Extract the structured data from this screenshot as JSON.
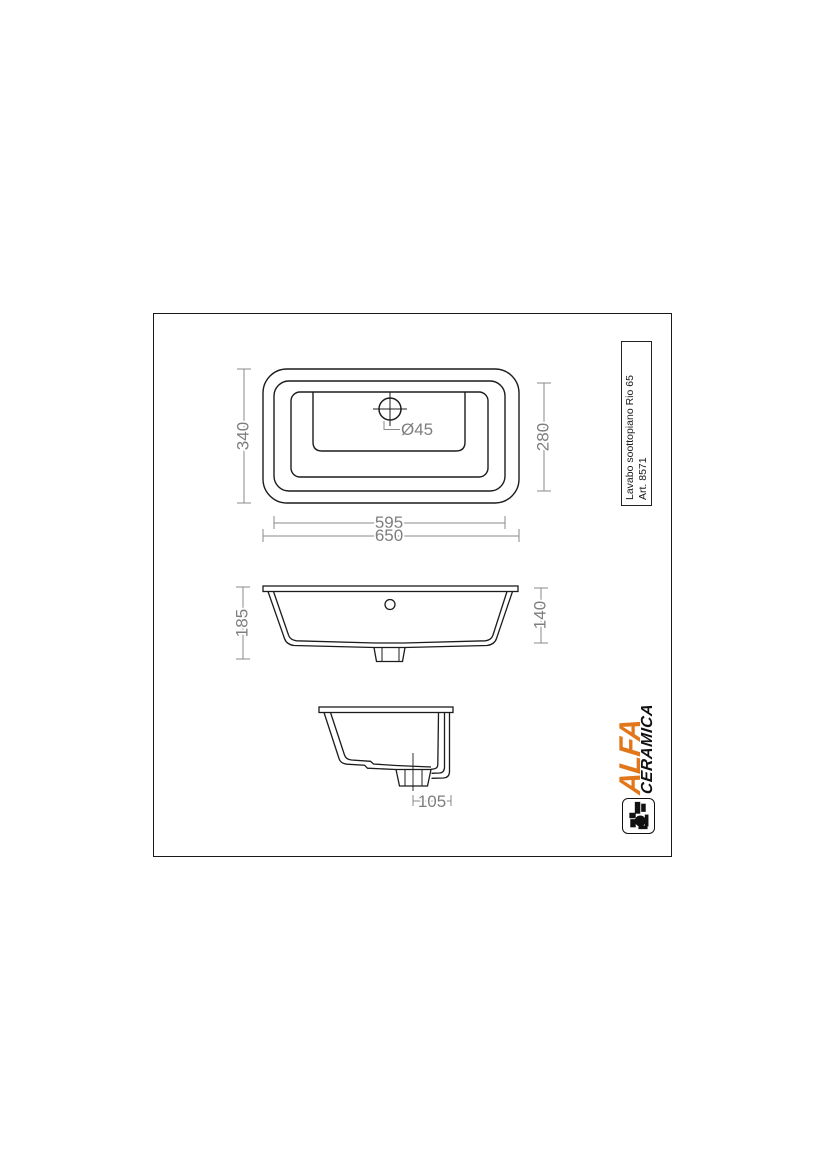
{
  "sheet": {
    "product_line1": "Lavabo soottopiano Rio 65",
    "product_line2": "Art. 8571"
  },
  "brand": {
    "primary": "ALFA",
    "secondary": "CERAMICA",
    "accent_color": "#e2761b"
  },
  "dimensions": {
    "plan_outer_width": "650",
    "plan_inner_width": "595",
    "plan_outer_depth": "340",
    "plan_inner_depth": "280",
    "drain_diameter": "Ø45",
    "front_total_height": "185",
    "front_basin_depth": "140",
    "side_drain_offset": "105"
  },
  "colors": {
    "line": "#1c1c1c",
    "dimension": "#8a8a8a"
  }
}
